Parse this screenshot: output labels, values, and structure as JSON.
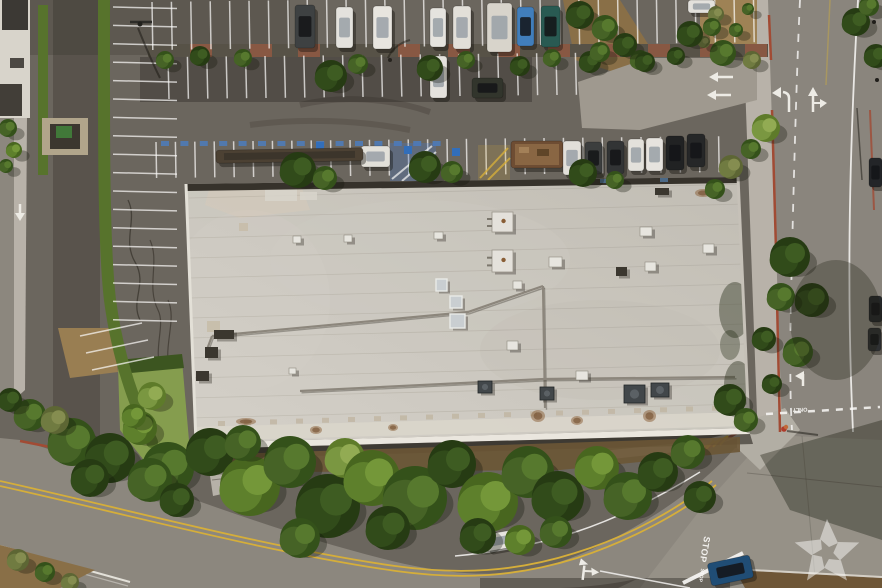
{
  "meta": {
    "type": "aerial-photograph",
    "subject": "Overhead drone photo of a large flat-roofed commercial building with surrounding parking lots, landscaped medians, tree-lined streets and a street intersection"
  },
  "markings": {
    "stop_primary": "STOP",
    "stop_secondary": "STOP",
    "only": "ONLY"
  },
  "watermark": {
    "icon": "pinwheel-star",
    "opacity": 0.5
  },
  "palette": {
    "asphaltLot": "#6b6660",
    "asphaltDark": "#56524d",
    "road": "#8d8982",
    "roadLight": "#97938b",
    "sidewalk": "#bbb6ae",
    "roof": "#cbc8c1",
    "roofLight": "#d8d5ce",
    "wall": "#efece5",
    "hedge": "#56742c",
    "dirt": "#a08457",
    "brick": "#9c5a42",
    "redCurb": "#a34a35",
    "yellowLine": "#d9b13b",
    "stallBlue": "#4a7fc9",
    "white": "#f2f1ed",
    "treeShades": {
      "d": [
        "#233a12",
        "#2e4a1a",
        "#3c5c22"
      ],
      "m": [
        "#31511a",
        "#446326",
        "#567a2e"
      ],
      "b": [
        "#46671f",
        "#5d822c",
        "#749a3a"
      ],
      "l": [
        "#5d7c2a",
        "#7a9a42",
        "#93ae55"
      ],
      "o": [
        "#5c6635",
        "#707c42",
        "#868f52"
      ]
    }
  },
  "stall_rows": [
    {
      "x": 113,
      "y": 7,
      "sx": 0,
      "sy": 18.4,
      "n": 18,
      "dx": 64,
      "dy": 1.5
    },
    {
      "x": 152,
      "y": 2,
      "sx": 19.4,
      "sy": -0.25,
      "n": 32,
      "dx": 0.8,
      "dy": 48
    },
    {
      "x": 168,
      "y": 57,
      "sx": 19.4,
      "sy": -0.2,
      "n": 22,
      "dx": 1,
      "dy": 42
    },
    {
      "x": 156,
      "y": 142,
      "sx": 19.4,
      "sy": -0.2,
      "n": 30,
      "dx": 0.6,
      "dy": 36
    },
    {
      "x": 80,
      "y": 336,
      "sx": 6,
      "sy": 17,
      "n": 3,
      "dx": 62,
      "dy": -13
    }
  ],
  "planter_bricks": [
    190,
    250,
    298,
    398,
    448,
    498,
    548,
    598,
    648,
    700,
    745
  ],
  "vehicles": [
    {
      "x": 295,
      "y": 5,
      "w": 20,
      "h": 43,
      "r": 0,
      "c": "#3c4043"
    },
    {
      "x": 336,
      "y": 7,
      "w": 17,
      "h": 41,
      "r": 0,
      "c": "#e9e8e4"
    },
    {
      "x": 373,
      "y": 6,
      "w": 19,
      "h": 43,
      "r": 0,
      "c": "#edebe7"
    },
    {
      "x": 430,
      "y": 8,
      "w": 16,
      "h": 39,
      "r": 0,
      "c": "#eae9e5"
    },
    {
      "x": 453,
      "y": 6,
      "w": 18,
      "h": 43,
      "r": 0,
      "c": "#e6e4df"
    },
    {
      "x": 487,
      "y": 3,
      "w": 25,
      "h": 49,
      "r": 0,
      "c": "#dcd9d2"
    },
    {
      "x": 517,
      "y": 7,
      "w": 17,
      "h": 39,
      "r": 0,
      "c": "#3f7fc1"
    },
    {
      "x": 541,
      "y": 6,
      "w": 19,
      "h": 41,
      "r": 0,
      "c": "#265a54"
    },
    {
      "x": 688,
      "y": 0,
      "w": 27,
      "h": 13,
      "r": 0,
      "c": "#e8e7e3"
    },
    {
      "x": 430,
      "y": 56,
      "w": 17,
      "h": 42,
      "r": 0,
      "c": "#e9e8e4"
    },
    {
      "x": 472,
      "y": 78,
      "w": 31,
      "h": 20,
      "r": 0,
      "c": "#2f332c"
    },
    {
      "x": 361,
      "y": 146,
      "w": 29,
      "h": 21,
      "r": 0,
      "c": "#e7e5e0"
    },
    {
      "x": 216,
      "y": 149,
      "w": 147,
      "h": 13,
      "r": -1,
      "c": "#4a4034",
      "t": "trailer"
    },
    {
      "x": 511,
      "y": 141,
      "w": 52,
      "h": 27,
      "r": 0,
      "c": "#6e4c33",
      "t": "dumpster"
    },
    {
      "x": 563,
      "y": 141,
      "w": 18,
      "h": 34,
      "r": 0,
      "c": "#e6e4e0"
    },
    {
      "x": 585,
      "y": 142,
      "w": 17,
      "h": 32,
      "r": 0,
      "c": "#3a3d3f"
    },
    {
      "x": 607,
      "y": 141,
      "w": 17,
      "h": 33,
      "r": 0,
      "c": "#2f3236"
    },
    {
      "x": 628,
      "y": 139,
      "w": 16,
      "h": 32,
      "r": 0,
      "c": "#e8e6e2"
    },
    {
      "x": 646,
      "y": 138,
      "w": 17,
      "h": 33,
      "r": 0,
      "c": "#ebe9e5"
    },
    {
      "x": 666,
      "y": 136,
      "w": 18,
      "h": 34,
      "r": 0,
      "c": "#1e2023"
    },
    {
      "x": 687,
      "y": 134,
      "w": 18,
      "h": 33,
      "r": 0,
      "c": "#232528"
    },
    {
      "x": 485,
      "y": 532,
      "w": 32,
      "h": 17,
      "r": -10,
      "c": "#eceae7"
    },
    {
      "x": 709,
      "y": 559,
      "w": 43,
      "h": 23,
      "r": -12,
      "c": "#1d4c78"
    },
    {
      "x": 869,
      "y": 158,
      "w": 13,
      "h": 29,
      "r": 0,
      "c": "#202328"
    },
    {
      "x": 869,
      "y": 296,
      "w": 13,
      "h": 26,
      "r": 0,
      "c": "#23262a"
    },
    {
      "x": 868,
      "y": 328,
      "w": 13,
      "h": 23,
      "r": 0,
      "c": "#2b2e32"
    }
  ],
  "trees": [
    [
      165,
      60,
      9,
      "m"
    ],
    [
      200,
      56,
      10,
      "d"
    ],
    [
      243,
      58,
      9,
      "m"
    ],
    [
      331,
      76,
      16,
      "d"
    ],
    [
      358,
      64,
      10,
      "m"
    ],
    [
      430,
      68,
      13,
      "d"
    ],
    [
      466,
      60,
      9,
      "m"
    ],
    [
      520,
      66,
      10,
      "d"
    ],
    [
      552,
      58,
      9,
      "m"
    ],
    [
      590,
      62,
      11,
      "d"
    ],
    [
      640,
      60,
      10,
      "m"
    ],
    [
      676,
      56,
      9,
      "d"
    ],
    [
      723,
      53,
      13,
      "m"
    ],
    [
      752,
      60,
      9,
      "o"
    ],
    [
      298,
      170,
      18,
      "d"
    ],
    [
      325,
      178,
      12,
      "m"
    ],
    [
      425,
      167,
      16,
      "d"
    ],
    [
      452,
      172,
      11,
      "m"
    ],
    [
      583,
      173,
      14,
      "d"
    ],
    [
      615,
      180,
      9,
      "m"
    ],
    [
      580,
      15,
      14,
      "d"
    ],
    [
      605,
      28,
      13,
      "m"
    ],
    [
      625,
      45,
      12,
      "d"
    ],
    [
      600,
      52,
      10,
      "m"
    ],
    [
      645,
      62,
      10,
      "d"
    ],
    [
      716,
      14,
      8,
      "o"
    ],
    [
      736,
      30,
      7,
      "m"
    ],
    [
      704,
      42,
      6,
      "o"
    ],
    [
      748,
      9,
      6,
      "m"
    ],
    [
      766,
      128,
      14,
      "l"
    ],
    [
      751,
      149,
      10,
      "m"
    ],
    [
      731,
      167,
      12,
      "o"
    ],
    [
      715,
      189,
      10,
      "m"
    ],
    [
      790,
      257,
      20,
      "d"
    ],
    [
      812,
      300,
      17,
      "d"
    ],
    [
      781,
      297,
      14,
      "m"
    ],
    [
      764,
      339,
      12,
      "d"
    ],
    [
      798,
      352,
      15,
      "m"
    ],
    [
      772,
      384,
      10,
      "d"
    ],
    [
      690,
      34,
      13,
      "d"
    ],
    [
      712,
      27,
      9,
      "m"
    ],
    [
      856,
      22,
      14,
      "d"
    ],
    [
      876,
      56,
      12,
      "d"
    ],
    [
      869,
      6,
      10,
      "m"
    ],
    [
      730,
      400,
      16,
      "d"
    ],
    [
      746,
      420,
      12,
      "m"
    ],
    [
      168,
      468,
      26,
      "m"
    ],
    [
      210,
      452,
      24,
      "d"
    ],
    [
      250,
      486,
      30,
      "b"
    ],
    [
      290,
      462,
      26,
      "m"
    ],
    [
      328,
      506,
      32,
      "d"
    ],
    [
      345,
      458,
      20,
      "l"
    ],
    [
      372,
      478,
      28,
      "b"
    ],
    [
      415,
      498,
      32,
      "m"
    ],
    [
      452,
      464,
      24,
      "d"
    ],
    [
      488,
      502,
      30,
      "b"
    ],
    [
      528,
      472,
      26,
      "m"
    ],
    [
      558,
      497,
      26,
      "d"
    ],
    [
      597,
      468,
      22,
      "b"
    ],
    [
      628,
      496,
      24,
      "m"
    ],
    [
      658,
      472,
      20,
      "d"
    ],
    [
      688,
      452,
      17,
      "m"
    ],
    [
      700,
      497,
      16,
      "d"
    ],
    [
      243,
      443,
      18,
      "m"
    ],
    [
      388,
      528,
      22,
      "d"
    ],
    [
      300,
      538,
      20,
      "m"
    ],
    [
      478,
      536,
      18,
      "d"
    ],
    [
      520,
      540,
      15,
      "b"
    ],
    [
      556,
      532,
      16,
      "m"
    ],
    [
      72,
      442,
      24,
      "m"
    ],
    [
      110,
      458,
      25,
      "d"
    ],
    [
      140,
      428,
      17,
      "b"
    ],
    [
      90,
      478,
      19,
      "d"
    ],
    [
      150,
      480,
      22,
      "m"
    ],
    [
      177,
      500,
      17,
      "d"
    ],
    [
      30,
      415,
      16,
      "m"
    ],
    [
      10,
      400,
      12,
      "d"
    ],
    [
      55,
      420,
      14,
      "o"
    ],
    [
      18,
      560,
      11,
      "o"
    ],
    [
      45,
      572,
      10,
      "m"
    ],
    [
      70,
      582,
      9,
      "o"
    ],
    [
      8,
      128,
      9,
      "m"
    ],
    [
      14,
      150,
      8,
      "b"
    ],
    [
      6,
      166,
      7,
      "m"
    ],
    [
      152,
      396,
      14,
      "l"
    ],
    [
      134,
      416,
      12,
      "b"
    ]
  ],
  "roof_features": [
    {
      "x": 265,
      "y": 188,
      "w": 32,
      "h": 13,
      "t": "patch"
    },
    {
      "x": 300,
      "y": 192,
      "w": 17,
      "h": 8,
      "t": "patch"
    },
    {
      "x": 239,
      "y": 223,
      "w": 9,
      "h": 8,
      "t": "pad"
    },
    {
      "x": 207,
      "y": 321,
      "w": 13,
      "h": 11,
      "t": "pad"
    },
    {
      "x": 214,
      "y": 330,
      "w": 20,
      "h": 9,
      "t": "dark"
    },
    {
      "x": 205,
      "y": 347,
      "w": 13,
      "h": 11,
      "t": "dark"
    },
    {
      "x": 196,
      "y": 371,
      "w": 13,
      "h": 10,
      "t": "dark"
    },
    {
      "x": 293,
      "y": 236,
      "w": 8,
      "h": 7,
      "t": "vent"
    },
    {
      "x": 344,
      "y": 235,
      "w": 8,
      "h": 7,
      "t": "vent"
    },
    {
      "x": 434,
      "y": 232,
      "w": 9,
      "h": 7,
      "t": "vent"
    },
    {
      "x": 492,
      "y": 212,
      "w": 21,
      "h": 20,
      "t": "rtu"
    },
    {
      "x": 492,
      "y": 250,
      "w": 21,
      "h": 22,
      "t": "rtu"
    },
    {
      "x": 549,
      "y": 257,
      "w": 13,
      "h": 10,
      "t": "vent"
    },
    {
      "x": 640,
      "y": 227,
      "w": 12,
      "h": 9,
      "t": "vent"
    },
    {
      "x": 645,
      "y": 262,
      "w": 11,
      "h": 9,
      "t": "vent"
    },
    {
      "x": 703,
      "y": 244,
      "w": 11,
      "h": 9,
      "t": "vent"
    },
    {
      "x": 616,
      "y": 267,
      "w": 11,
      "h": 9,
      "t": "dark"
    },
    {
      "x": 513,
      "y": 281,
      "w": 9,
      "h": 8,
      "t": "vent"
    },
    {
      "x": 436,
      "y": 279,
      "w": 11,
      "h": 12,
      "t": "sky"
    },
    {
      "x": 450,
      "y": 296,
      "w": 12,
      "h": 12,
      "t": "sky"
    },
    {
      "x": 450,
      "y": 314,
      "w": 15,
      "h": 14,
      "t": "sky"
    },
    {
      "x": 507,
      "y": 341,
      "w": 11,
      "h": 9,
      "t": "vent"
    },
    {
      "x": 576,
      "y": 371,
      "w": 12,
      "h": 9,
      "t": "vent"
    },
    {
      "x": 478,
      "y": 381,
      "w": 14,
      "h": 12,
      "t": "hvac"
    },
    {
      "x": 540,
      "y": 387,
      "w": 14,
      "h": 13,
      "t": "hvac"
    },
    {
      "x": 624,
      "y": 385,
      "w": 21,
      "h": 18,
      "t": "hvac"
    },
    {
      "x": 651,
      "y": 383,
      "w": 18,
      "h": 14,
      "t": "hvac"
    },
    {
      "x": 655,
      "y": 188,
      "w": 14,
      "h": 7,
      "t": "dark"
    },
    {
      "x": 531,
      "y": 410,
      "w": 14,
      "h": 12,
      "t": "stain"
    },
    {
      "x": 643,
      "y": 410,
      "w": 13,
      "h": 12,
      "t": "stain"
    },
    {
      "x": 571,
      "y": 416,
      "w": 12,
      "h": 9,
      "t": "stain"
    },
    {
      "x": 310,
      "y": 426,
      "w": 12,
      "h": 8,
      "t": "stain"
    },
    {
      "x": 388,
      "y": 424,
      "w": 10,
      "h": 7,
      "t": "stain"
    },
    {
      "x": 695,
      "y": 189,
      "w": 16,
      "h": 8,
      "t": "stain"
    },
    {
      "x": 236,
      "y": 418,
      "w": 20,
      "h": 7,
      "t": "stain"
    },
    {
      "x": 289,
      "y": 368,
      "w": 7,
      "h": 6,
      "t": "vent"
    }
  ],
  "conduits": [
    [
      [
        206,
        352
      ],
      [
        212,
        336
      ]
    ],
    [
      [
        212,
        336
      ],
      [
        468,
        312
      ],
      [
        543,
        286
      ]
    ],
    [
      [
        543,
        286
      ],
      [
        545,
        408
      ]
    ],
    [
      [
        300,
        391
      ],
      [
        544,
        379
      ],
      [
        735,
        377
      ]
    ]
  ]
}
